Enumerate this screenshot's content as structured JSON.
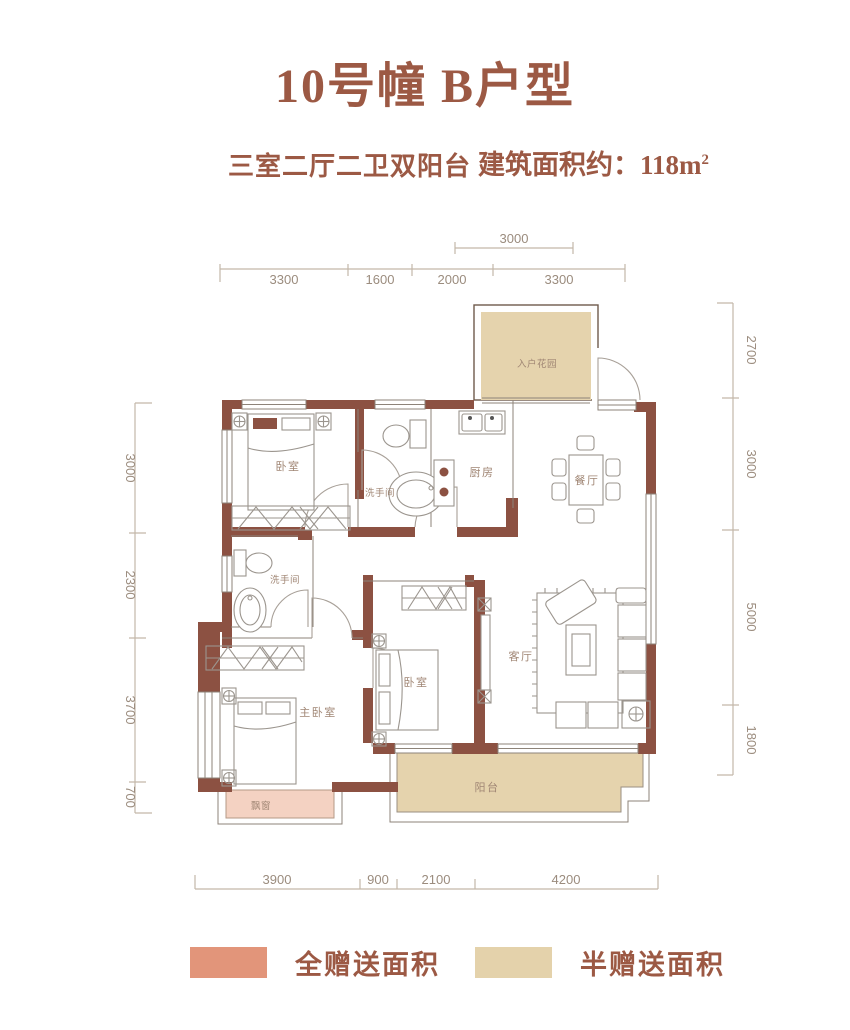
{
  "header": {
    "title": "10号幢 B户型",
    "layout_label": "三室二厅二卫双阳台",
    "area_prefix": "建筑面积约：",
    "area_value": "118m",
    "area_sup": "2"
  },
  "floorplan": {
    "rooms": {
      "entry_garden": "入户花园",
      "bedroom_top": "卧室",
      "bathroom_top": "洗手间",
      "kitchen": "厨房",
      "dining": "餐厅",
      "bathroom_left": "洗手间",
      "master_bedroom": "主卧室",
      "bedroom_mid": "卧室",
      "living": "客厅",
      "balcony": "阳台",
      "bay_window": "飘窗"
    },
    "dimensions": {
      "top_secondary": [
        "3000"
      ],
      "top": [
        "3300",
        "1600",
        "2000",
        "3300"
      ],
      "left": [
        "3000",
        "2300",
        "3700",
        "700"
      ],
      "right": [
        "2700",
        "3000",
        "5000",
        "1800"
      ],
      "bottom": [
        "3900",
        "900",
        "2100",
        "4200"
      ]
    }
  },
  "legend": {
    "items": [
      {
        "label": "全赠送面积",
        "color": "#E2957A"
      },
      {
        "label": "半赠送面积",
        "color": "#E4D2AB"
      }
    ]
  },
  "colors": {
    "wall": "#8C5142",
    "accent_text": "#9C5944",
    "dim_text": "#9B8C7E",
    "full_gift": "#E2957A",
    "half_gift": "#E4D2AB",
    "bay_window_fill": "#F4D2C2",
    "furniture_line": "#9B958E"
  }
}
